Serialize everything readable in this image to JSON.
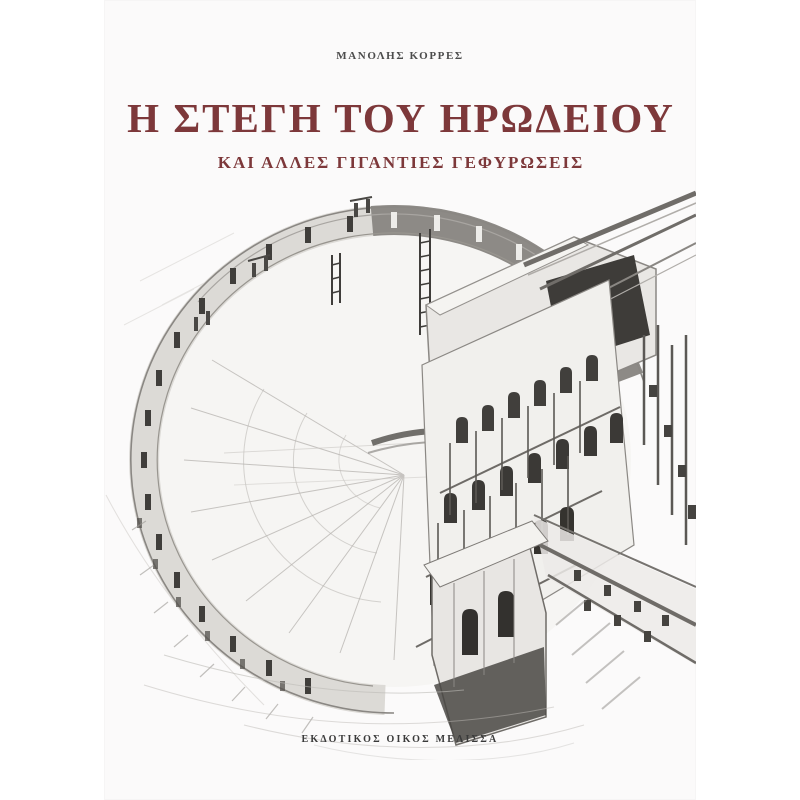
{
  "page": {
    "background": "#ffffff"
  },
  "cover": {
    "author": "ΜΑΝΟΛΗΣ ΚΟΡΡΕΣ",
    "title": "Η ΣΤΕΓΗ ΤΟΥ ΗΡΩΔΕΙΟΥ",
    "subtitle": "ΚΑΙ ΑΛΛΕΣ ΓΙΓΑΝΤΙΕΣ ΓΕΦΥΡΩΣΕΙΣ",
    "publisher": "ΕΚΔΟΤΙΚΟΣ ΟΙΚΟΣ ΜΕΛΙΣΣΑ",
    "illustration": {
      "alt": "Engraved cutaway axonometric drawing of the Odeon of Herodes Atticus: semicircular cavea with arched outer wall, sketched seating bowl, and tall multi-storey arched stage building with giant roof spans"
    },
    "colors": {
      "title_maroon": "#7d383a",
      "author_gray": "#4c4c4c",
      "publisher_gray": "#3a3a3a",
      "paper": "#fbfafa",
      "ink": "#45433f"
    }
  }
}
